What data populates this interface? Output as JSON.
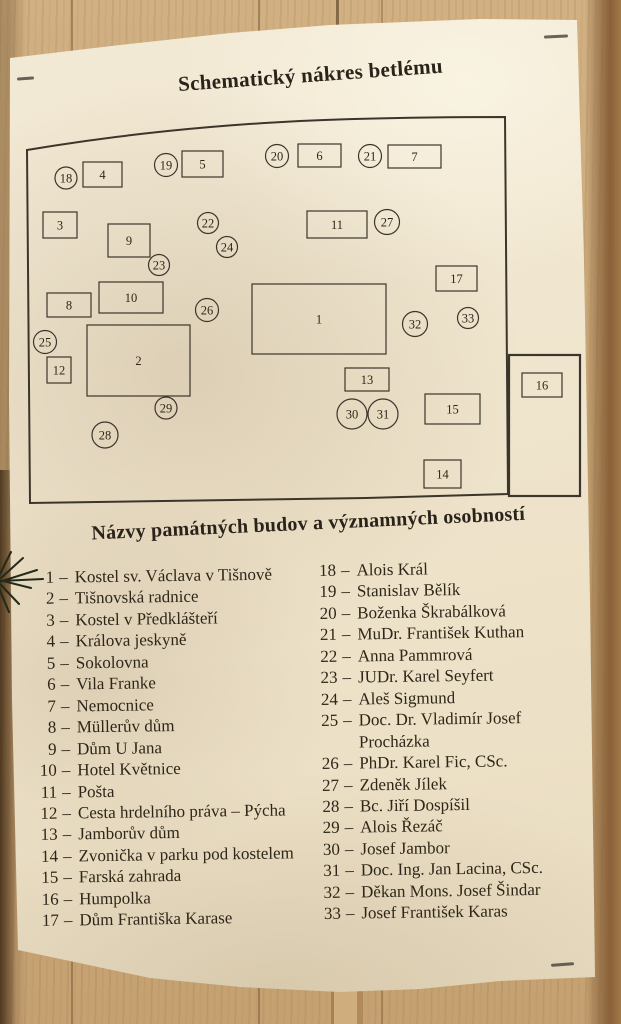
{
  "title": "Schematický nákres betlému",
  "legend": {
    "heading": "Názvy památných budov a významných osobností",
    "separator": "–",
    "left": [
      {
        "num": "1",
        "name": "Kostel sv. Václava v Tišnově"
      },
      {
        "num": "2",
        "name": "Tišnovská radnice"
      },
      {
        "num": "3",
        "name": "Kostel v Předklášteří"
      },
      {
        "num": "4",
        "name": "Králova jeskyně"
      },
      {
        "num": "5",
        "name": "Sokolovna"
      },
      {
        "num": "6",
        "name": "Vila Franke"
      },
      {
        "num": "7",
        "name": "Nemocnice"
      },
      {
        "num": "8",
        "name": "Müllerův dům"
      },
      {
        "num": "9",
        "name": "Dům U Jana"
      },
      {
        "num": "10",
        "name": "Hotel Květnice"
      },
      {
        "num": "11",
        "name": "Pošta"
      },
      {
        "num": "12",
        "name": "Cesta hrdelního práva – Pýcha"
      },
      {
        "num": "13",
        "name": "Jamborův dům"
      },
      {
        "num": "14",
        "name": "Zvonička v parku pod kostelem"
      },
      {
        "num": "15",
        "name": "Farská zahrada"
      },
      {
        "num": "16",
        "name": "Humpolka"
      },
      {
        "num": "17",
        "name": "Dům Františka Karase"
      }
    ],
    "right": [
      {
        "num": "18",
        "name": "Alois Král"
      },
      {
        "num": "19",
        "name": "Stanislav Bělík"
      },
      {
        "num": "20",
        "name": "Boženka Škrabálková"
      },
      {
        "num": "21",
        "name": "MuDr. František Kuthan"
      },
      {
        "num": "22",
        "name": "Anna Pammrová"
      },
      {
        "num": "23",
        "name": "JUDr. Karel Seyfert"
      },
      {
        "num": "24",
        "name": "Aleš Sigmund"
      },
      {
        "num": "25",
        "name": "Doc. Dr. Vladimír Josef Procházka"
      },
      {
        "num": "26",
        "name": "PhDr. Karel Fic, CSc."
      },
      {
        "num": "27",
        "name": "Zdeněk Jílek"
      },
      {
        "num": "28",
        "name": "Bc. Jiří Dospíšil"
      },
      {
        "num": "29",
        "name": "Alois Řezáč"
      },
      {
        "num": "30",
        "name": "Josef Jambor"
      },
      {
        "num": "31",
        "name": "Doc. Ing. Jan Lacina, CSc."
      },
      {
        "num": "32",
        "name": "Děkan Mons. Josef Šindar"
      },
      {
        "num": "33",
        "name": "Josef František Karas"
      }
    ]
  },
  "diagram": {
    "outline_path": "M27,150 C110,136 200,126 300,121 C370,118 440,117 505,117 L508,494 L366,498 L30,503 Z",
    "annex": {
      "x": 509,
      "y": 355,
      "w": 71,
      "h": 141
    },
    "rects": [
      {
        "label": "1",
        "x": 252,
        "y": 284,
        "w": 134,
        "h": 70
      },
      {
        "label": "2",
        "x": 87,
        "y": 325,
        "w": 103,
        "h": 71
      },
      {
        "label": "3",
        "x": 43,
        "y": 212,
        "w": 34,
        "h": 26
      },
      {
        "label": "4",
        "x": 83,
        "y": 162,
        "w": 39,
        "h": 25
      },
      {
        "label": "5",
        "x": 182,
        "y": 151,
        "w": 41,
        "h": 26
      },
      {
        "label": "6",
        "x": 298,
        "y": 144,
        "w": 43,
        "h": 23
      },
      {
        "label": "7",
        "x": 388,
        "y": 145,
        "w": 53,
        "h": 23
      },
      {
        "label": "8",
        "x": 47,
        "y": 293,
        "w": 44,
        "h": 24
      },
      {
        "label": "9",
        "x": 108,
        "y": 224,
        "w": 42,
        "h": 33
      },
      {
        "label": "10",
        "x": 99,
        "y": 282,
        "w": 64,
        "h": 31
      },
      {
        "label": "11",
        "x": 307,
        "y": 211,
        "w": 60,
        "h": 27
      },
      {
        "label": "12",
        "x": 47,
        "y": 357,
        "w": 24,
        "h": 26
      },
      {
        "label": "13",
        "x": 345,
        "y": 368,
        "w": 44,
        "h": 23
      },
      {
        "label": "14",
        "x": 424,
        "y": 460,
        "w": 37,
        "h": 28
      },
      {
        "label": "15",
        "x": 425,
        "y": 394,
        "w": 55,
        "h": 30
      },
      {
        "label": "16",
        "x": 522,
        "y": 373,
        "w": 40,
        "h": 24
      },
      {
        "label": "17",
        "x": 436,
        "y": 266,
        "w": 41,
        "h": 25
      }
    ],
    "circles": [
      {
        "label": "18",
        "cx": 66,
        "cy": 178,
        "r": 11
      },
      {
        "label": "19",
        "cx": 166,
        "cy": 165,
        "r": 11.5
      },
      {
        "label": "20",
        "cx": 277,
        "cy": 156,
        "r": 11.5
      },
      {
        "label": "21",
        "cx": 370,
        "cy": 156,
        "r": 11.5
      },
      {
        "label": "22",
        "cx": 208,
        "cy": 223,
        "r": 10.5
      },
      {
        "label": "23",
        "cx": 159,
        "cy": 265,
        "r": 10.5
      },
      {
        "label": "24",
        "cx": 227,
        "cy": 247,
        "r": 10.5
      },
      {
        "label": "25",
        "cx": 45,
        "cy": 342,
        "r": 11.5
      },
      {
        "label": "26",
        "cx": 207,
        "cy": 310,
        "r": 11.5
      },
      {
        "label": "27",
        "cx": 387,
        "cy": 222,
        "r": 12.5
      },
      {
        "label": "28",
        "cx": 105,
        "cy": 435,
        "r": 13
      },
      {
        "label": "29",
        "cx": 166,
        "cy": 408,
        "r": 11
      },
      {
        "label": "30",
        "cx": 352,
        "cy": 414,
        "r": 15
      },
      {
        "label": "31",
        "cx": 383,
        "cy": 414,
        "r": 15
      },
      {
        "label": "32",
        "cx": 415,
        "cy": 324,
        "r": 12.5
      },
      {
        "label": "33",
        "cx": 468,
        "cy": 318,
        "r": 10.5
      }
    ]
  },
  "colors": {
    "ink": "#2e2719",
    "diagram_line": "#3c352b",
    "paper": "#efe4cc",
    "wood": "#cbaa7a",
    "branch": "#222a1a"
  }
}
